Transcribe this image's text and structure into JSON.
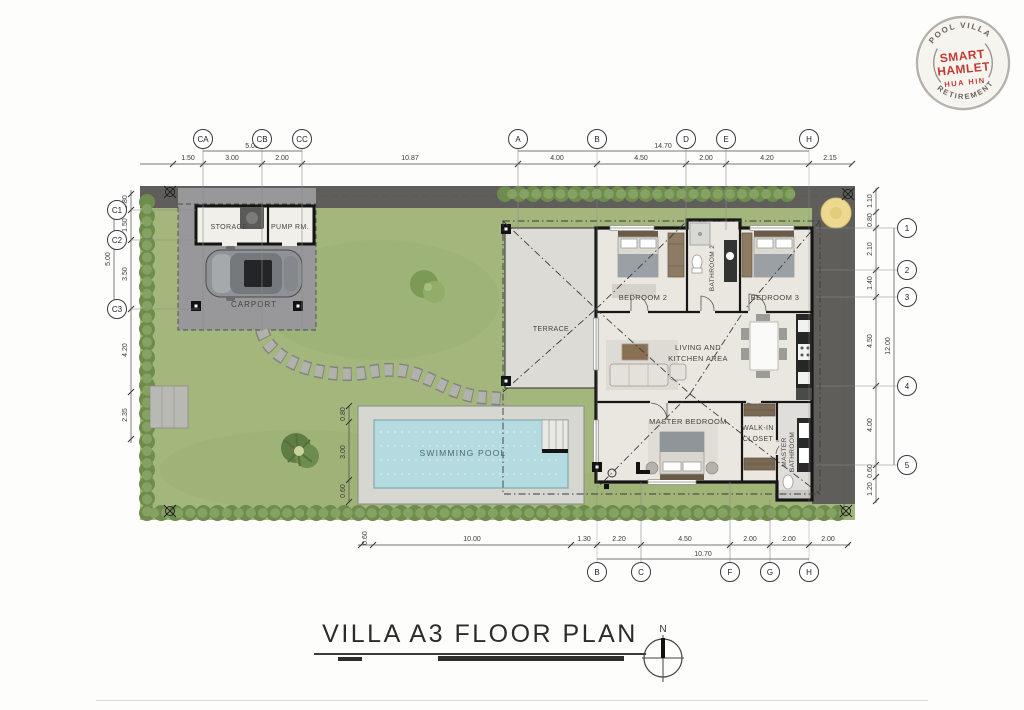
{
  "logo": {
    "top_arc": "POOL VILLA",
    "name_line1": "SMART",
    "name_line2": "HAMLET",
    "name_line3": "HUA HIN",
    "bottom_arc": "RETIREMENT",
    "red": "#c13b33",
    "ring_gray": "#b5b2ac"
  },
  "title": {
    "text": "VILLA A3 FLOOR PLAN"
  },
  "north": {
    "label": "N"
  },
  "rooms": {
    "storage": "STORAGE",
    "pump": "PUMP RM.",
    "carport": "CARPORT",
    "terrace": "TERRACE",
    "bedroom2": "BEDROOM 2",
    "bathroom2": "BATHROOM 2",
    "bedroom3": "BEDROOM 3",
    "living_line1": "LIVING AND",
    "living_line2": "KITCHEN AREA",
    "master_bedroom": "MASTER BEDROOM",
    "walkin_line1": "WALK-IN",
    "walkin_line2": "CLOSET",
    "master_bath_line1": "MASTER",
    "master_bath_line2": "BATHROOM",
    "pool": "SWIMMING POOL"
  },
  "grid": {
    "top": [
      "CA",
      "CB",
      "CC",
      "A",
      "B",
      "D",
      "E",
      "H"
    ],
    "bottom": [
      "B",
      "C",
      "F",
      "G",
      "H"
    ],
    "left": [
      "C1",
      "C2",
      "C3"
    ],
    "right": [
      "1",
      "2",
      "3",
      "4",
      "5"
    ]
  },
  "dims": {
    "top": [
      "1.50",
      "3.00",
      "2.00",
      "10.87",
      "4.00",
      "4.50",
      "2.00",
      "4.20",
      "2.15"
    ],
    "top_overall": [
      "5.00",
      "14.70"
    ],
    "left": [
      "0.80",
      "1.50",
      "3.50",
      "4.20",
      "2.35"
    ],
    "left_overall": "5.00",
    "right": [
      "1.10",
      "0.80",
      "2.10",
      "1.40",
      "4.50",
      "4.00",
      "0.60",
      "1.20"
    ],
    "right_overall": "12.00",
    "bottom": [
      "0.60",
      "10.00",
      "1.30",
      "2.20",
      "4.50",
      "2.00",
      "2.00",
      "2.00"
    ],
    "bottom_overall": "10.70",
    "pool": [
      "0.80",
      "3.00",
      "0.60"
    ]
  },
  "colors": {
    "grass": "#a3b77d",
    "hedge": "#7b9859",
    "pool_water": "#b3dbe0",
    "pavement": "#98989a",
    "dark_strip": "#5f5e5a"
  }
}
